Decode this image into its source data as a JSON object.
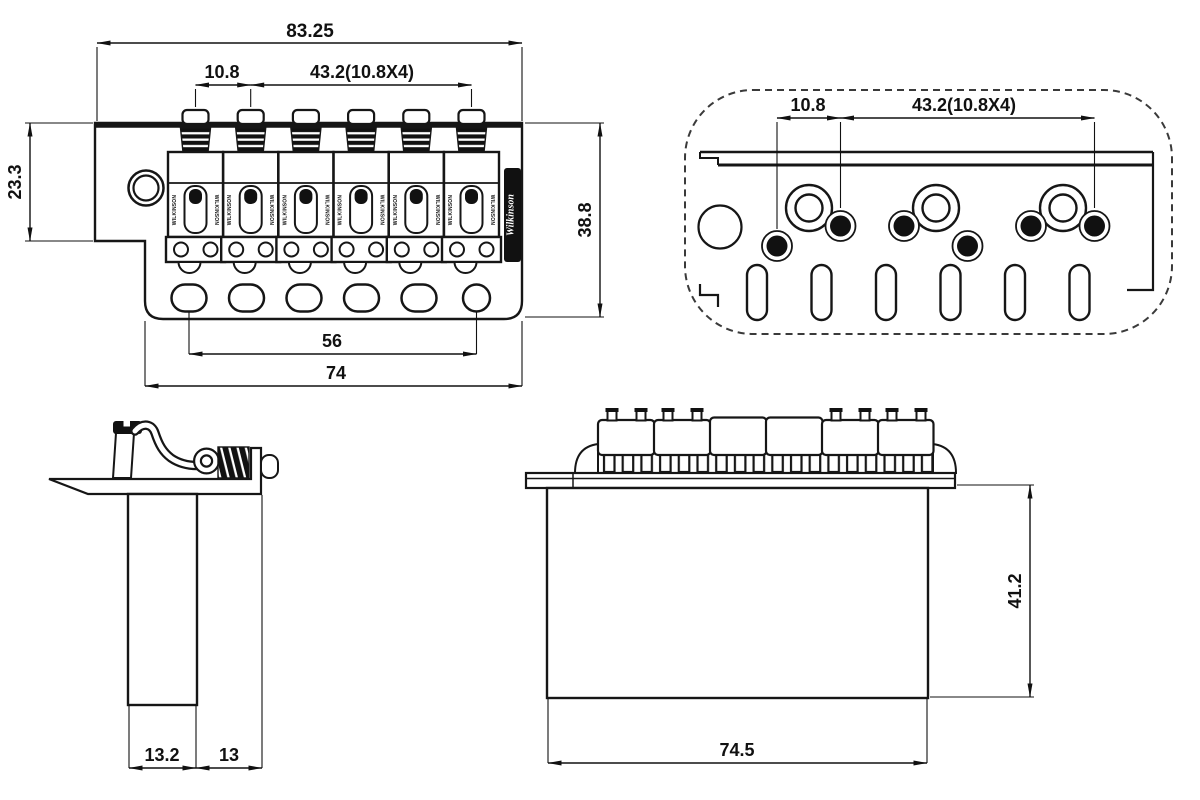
{
  "title": "Tremolo bridge dimension drawing",
  "brand": {
    "saddle_text": "WILKINSON",
    "logo_text": "Wilkinson"
  },
  "front_view": {
    "dim_overall_width": "83.25",
    "dim_string_pitch": "10.8",
    "dim_string_span": "43.2(10.8X4)",
    "dim_left_height": "23.3",
    "dim_right_height": "38.8",
    "dim_mount_hole_span": "56",
    "dim_plate_width": "74"
  },
  "top_view": {
    "dim_string_pitch": "10.8",
    "dim_string_span": "43.2(10.8X4)"
  },
  "side_view": {
    "dim_block_thickness": "13.2",
    "dim_back_offset": "13"
  },
  "rear_view": {
    "dim_block_width": "74.5",
    "dim_overall_height": "41.2"
  }
}
